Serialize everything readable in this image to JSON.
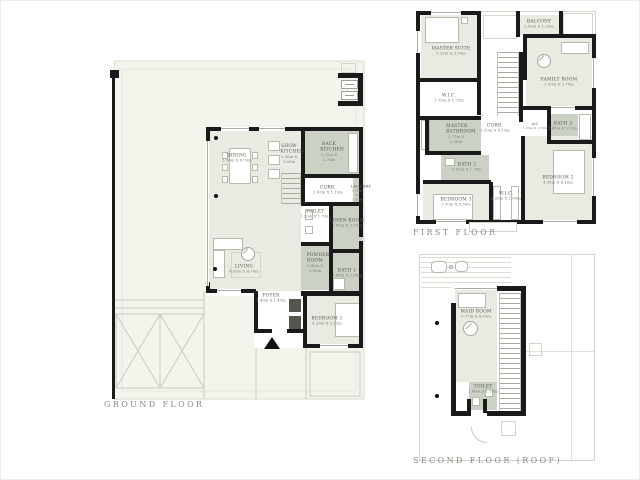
{
  "colors": {
    "wall": "#1a1a1a",
    "room_light": "#e9ebe3",
    "room_wet": "#ccd1c5",
    "site": "#f3f4ec",
    "label": "#565851",
    "title": "#8a8b84"
  },
  "floors": {
    "ground": {
      "title": "GROUND FLOOR",
      "rooms": [
        {
          "name": "DINING",
          "dims": "3.90m X 4.70m"
        },
        {
          "name": "SHOW KITCHEN",
          "dims": "2.30m X 3.00m"
        },
        {
          "name": "BACK KITCHEN",
          "dims": "2.75m X 2.70m"
        },
        {
          "name": "CORR.",
          "dims": "2.47m X 1.10m"
        },
        {
          "name": "LAUNDRY",
          "dims": "0.75m X 1.50m"
        },
        {
          "name": "TOILET",
          "dims": "1.20m X 1.70m"
        },
        {
          "name": "LINEN ROOM",
          "dims": "1.80m X 2.90m"
        },
        {
          "name": "POWDER ROOM",
          "dims": "1.40m X 1.90m"
        },
        {
          "name": "LIVING",
          "dims": "4.09m X 4.70m"
        },
        {
          "name": "BATH 1",
          "dims": "1.80m X 2.80m"
        },
        {
          "name": "FOYER",
          "dims": "1.40m X 1.45m"
        },
        {
          "name": "BEDROOM 1",
          "dims": "4.25m X 3.15m"
        }
      ]
    },
    "first": {
      "title": "FIRST FLOOR",
      "rooms": [
        {
          "name": "MASTER SUITE",
          "dims": "5.20m X 3.50m"
        },
        {
          "name": "BALCONY",
          "dims": "3.00m X 1.20m"
        },
        {
          "name": "FAMILY ROOM",
          "dims": "3.50m X 3.70m"
        },
        {
          "name": "W.I.C.",
          "dims": "1.75m X 1.75m"
        },
        {
          "name": "CORR.",
          "dims": "5.10m X 4.15m"
        },
        {
          "name": "MASTER BATHROOM",
          "dims": "2.77m X 2.60m"
        },
        {
          "name": "A/C",
          "dims": "1.35m X 1.70m"
        },
        {
          "name": "BATH 3",
          "dims": "1.48m X 2.90m"
        },
        {
          "name": "BATH 2",
          "dims": "3.05m X 1.75m"
        },
        {
          "name": "BEDROOM 3",
          "dims": "3.30m X 3.50m"
        },
        {
          "name": "W.I.C.",
          "dims": "2.26m X 1.00m"
        },
        {
          "name": "BEDROOM 2",
          "dims": "4.35m X 4.10m"
        }
      ]
    },
    "second": {
      "title": "SECOND FLOOR (ROOF)",
      "rooms": [
        {
          "name": "MAID ROOM",
          "dims": "2.77m X 4.00m"
        },
        {
          "name": "TOILET",
          "dims": "1.40m X 1.50m"
        }
      ]
    }
  }
}
